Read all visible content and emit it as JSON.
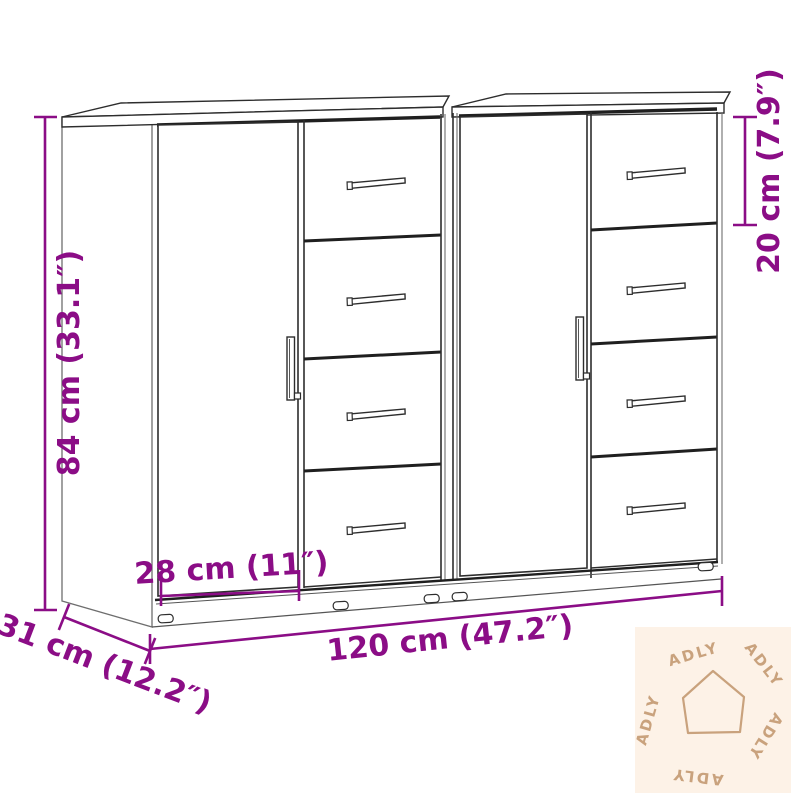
{
  "diagram": {
    "title": "Sideboard dimension diagram",
    "product": "Sideboards with doors and drawers (set of 2)",
    "dimensions": {
      "height": "84 cm (33.1″)",
      "width": "120 cm (47.2″)",
      "depth": "31 cm (12.2″)",
      "door_width": "28 cm (11″)",
      "top_drawer_height": "20 cm (7.9″)"
    },
    "colors": {
      "dimension_accent": "#8b0d86",
      "outline": "#2d2d2d",
      "watermark_bg": "#fdf2e7",
      "watermark_fg": "#c9a27d"
    }
  },
  "watermark": {
    "brand": "ADLY",
    "icon": "house-icon",
    "labels": [
      "ADLY",
      "ADLY",
      "ADLY",
      "ADLY",
      "ADLY"
    ]
  }
}
